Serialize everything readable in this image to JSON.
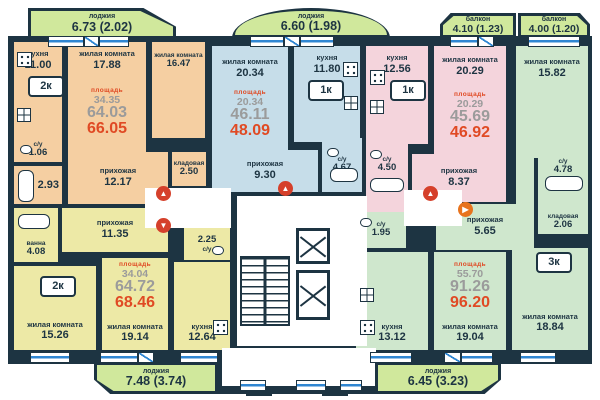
{
  "labels": {
    "area_caption": "площадь",
    "room_living": "жилая комната",
    "room_kitchen": "кухня",
    "room_hall": "прихожая",
    "room_storage": "кладовая",
    "room_bath": "ванна",
    "room_wc": "с/у",
    "loggia": "лоджия",
    "balcony": "балкон"
  },
  "icons": {
    "arrow_up": "▲",
    "arrow_down": "▼",
    "arrow_right": "▶"
  },
  "colors": {
    "wall": "#1d3442",
    "apt_orange": "#f5cfa2",
    "apt_blue": "#c6dde9",
    "apt_pink": "#f4d4dc",
    "apt_green": "#cfe7cd",
    "apt_yellow": "#ede9a6",
    "loggia_fill": "#d0e89c",
    "accent_red": "#e04a24",
    "num_gray": "#9b9b9b",
    "window_blue": "#2f86d2"
  },
  "apartments": {
    "orange_2k": {
      "badge": "2к",
      "area_living_total": "34.35",
      "area_total": "64.03",
      "area_full": "66.05",
      "rooms": {
        "kitchen": "11.00",
        "living_a": "17.88",
        "living_b": "16.47",
        "wc": "1.06",
        "bath": "2.93",
        "hall": "12.17",
        "storage": "2.50"
      }
    },
    "blue_1k": {
      "badge": "1к",
      "area_living_total": "20.34",
      "area_total": "46.11",
      "area_full": "48.09",
      "rooms": {
        "living": "20.34",
        "kitchen": "11.80",
        "hall": "9.30",
        "wc": "4.67"
      }
    },
    "pink_1k": {
      "badge": "1к",
      "area_living_total": "20.29",
      "area_total": "45.69",
      "area_full": "46.92",
      "rooms": {
        "kitchen": "12.56",
        "living": "20.29",
        "wc": "4.50",
        "hall": "8.37"
      }
    },
    "green_3k": {
      "badge": "3к",
      "area_living_total": "55.70",
      "area_total": "91.26",
      "area_full": "96.20",
      "rooms": {
        "living_a": "15.82",
        "wc_a": "4.78",
        "storage": "2.06",
        "hall": "5.65",
        "wc_b": "1.95",
        "kitchen": "13.12",
        "living_b": "19.04",
        "living_c": "18.84"
      }
    },
    "yellow_2k": {
      "badge": "2к",
      "area_living_total": "34.04",
      "area_total": "64.72",
      "area_full": "68.46",
      "rooms": {
        "hall": "11.35",
        "bath": "4.08",
        "wc": "2.25",
        "living_a": "15.26",
        "living_b": "19.14",
        "kitchen": "12.64"
      }
    }
  },
  "loggias": {
    "top_left": "6.73 (2.02)",
    "top_center": "6.60 (1.98)",
    "balcony_a": "4.10 (1.23)",
    "balcony_b": "4.00 (1.20)",
    "bottom_left": "7.48 (3.74)",
    "bottom_right": "6.45 (3.23)"
  }
}
